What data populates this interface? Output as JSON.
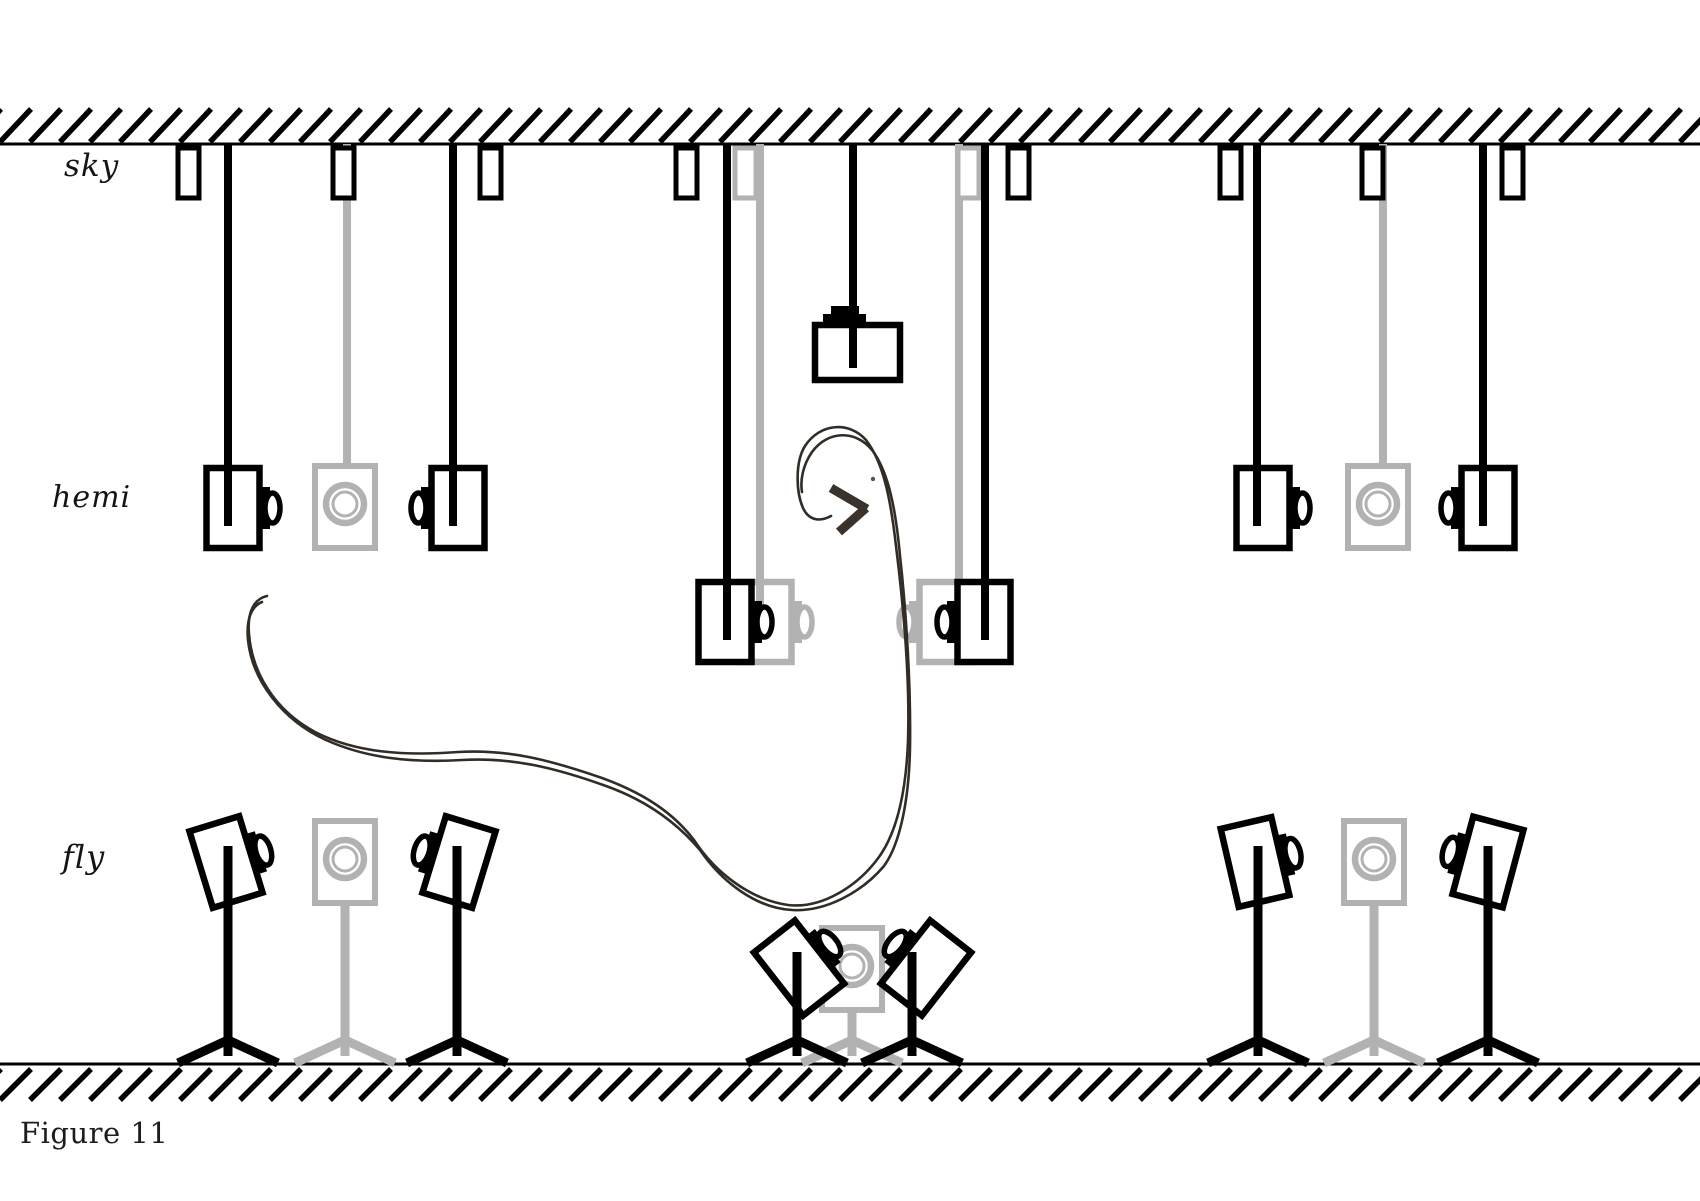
{
  "figure": {
    "caption": "Figure 11",
    "labels": [
      {
        "id": "sky",
        "text": "sky"
      },
      {
        "id": "hemi",
        "text": "hemi"
      },
      {
        "id": "fly",
        "text": "fly"
      }
    ],
    "colors": {
      "black": "#000000",
      "gray": "#b2b2b2",
      "path": "#312c26",
      "bat": "#39332c",
      "background": "#ffffff"
    },
    "canvas": {
      "w": 1700,
      "h": 1201
    },
    "ceiling": {
      "line_y": 144,
      "hatch": {
        "yb": 142,
        "yt": 109,
        "dx": 31,
        "spacing": 30,
        "stroke": 5.5
      }
    },
    "floor": {
      "line_y": 1064,
      "hatch": {
        "yb": 1100,
        "yt": 1069,
        "dx": 31,
        "spacing": 30,
        "stroke": 5.5
      }
    },
    "mounts": {
      "y": 148,
      "w": 21,
      "h": 50,
      "stroke": 5,
      "items": [
        {
          "x": 178,
          "c": "black"
        },
        {
          "x": 333,
          "c": "black"
        },
        {
          "x": 480,
          "c": "black"
        },
        {
          "x": 676,
          "c": "black"
        },
        {
          "x": 735,
          "c": "gray"
        },
        {
          "x": 958,
          "c": "gray"
        },
        {
          "x": 1008,
          "c": "black"
        },
        {
          "x": 1220,
          "c": "black"
        },
        {
          "x": 1362,
          "c": "black"
        },
        {
          "x": 1502,
          "c": "black"
        }
      ]
    },
    "rods": {
      "y1": 144,
      "stroke": 8,
      "black": [
        {
          "x": 228,
          "y2": 526
        },
        {
          "x": 453,
          "y2": 526
        },
        {
          "x": 727,
          "y2": 640
        },
        {
          "x": 853,
          "y2": 368
        },
        {
          "x": 985,
          "y2": 640
        },
        {
          "x": 1257,
          "y2": 526
        },
        {
          "x": 1483,
          "y2": 526
        }
      ],
      "gray": [
        {
          "x": 347,
          "y2": 469
        },
        {
          "x": 760,
          "y2": 640
        },
        {
          "x": 959,
          "y2": 640
        },
        {
          "x": 1383,
          "y2": 469
        }
      ]
    },
    "hanging_cameras": {
      "w": 53,
      "h": 80,
      "black": [
        {
          "cx": 233,
          "cy": 508,
          "face": 1
        },
        {
          "cx": 458,
          "cy": 508,
          "face": -1
        },
        {
          "cx": 725,
          "cy": 622,
          "face": 1
        },
        {
          "cx": 984,
          "cy": 622,
          "face": -1
        },
        {
          "cx": 1263,
          "cy": 508,
          "face": 1
        },
        {
          "cx": 1488,
          "cy": 508,
          "face": -1
        }
      ],
      "gray": [
        {
          "cx": 765,
          "cy": 622,
          "face": 1
        },
        {
          "cx": 946,
          "cy": 622,
          "face": -1
        }
      ]
    },
    "hanging_speakers": [
      {
        "cx": 345,
        "top": 466
      },
      {
        "cx": 1378,
        "top": 466
      }
    ],
    "ceiling_camera": {
      "x": 815,
      "y": 325,
      "w": 85,
      "h": 55,
      "rod_x": 853,
      "cap1": [
        823,
        314,
        43,
        12
      ],
      "cap2": [
        831,
        306,
        28,
        9
      ]
    },
    "tripod_cameras": [
      {
        "cx": 226,
        "cy": 862,
        "rot": -17,
        "face": 1,
        "pole": 228
      },
      {
        "cx": 459,
        "cy": 862,
        "rot": 17,
        "face": -1,
        "pole": 457
      },
      {
        "cx": 799,
        "cy": 968,
        "rot": -38,
        "face": 1,
        "pole": 797
      },
      {
        "cx": 926,
        "cy": 968,
        "rot": 38,
        "face": -1,
        "pole": 912
      },
      {
        "cx": 1255,
        "cy": 862,
        "rot": -13,
        "face": 1,
        "pole": 1258
      },
      {
        "cx": 1488,
        "cy": 862,
        "rot": 15,
        "face": -1,
        "pole": 1488
      }
    ],
    "tripod_speakers": [
      {
        "cx": 345,
        "top": 821
      },
      {
        "cx": 852,
        "top": 928
      },
      {
        "cx": 1374,
        "top": 821
      }
    ],
    "tripods": {
      "junction_y": 1040,
      "foot_dx": 50,
      "foot_y": 1063,
      "stub_y": 1056,
      "stroke": 9,
      "black": [
        {
          "x": 228,
          "top": 846
        },
        {
          "x": 457,
          "top": 846
        },
        {
          "x": 797,
          "top": 952
        },
        {
          "x": 912,
          "top": 952
        },
        {
          "x": 1258,
          "top": 846
        },
        {
          "x": 1488,
          "top": 846
        }
      ],
      "gray": [
        {
          "x": 345,
          "top": 901
        },
        {
          "x": 852,
          "top": 1008
        },
        {
          "x": 1374,
          "top": 901
        }
      ]
    },
    "flight_path": {
      "stroke": 2.6,
      "strokes": [
        "M 267 596 C 254 599 247 612 249 634 C 252 672 274 710 315 732 C 356 753 405 756 458 752 C 508 749 550 760 602 778 C 646 794 674 814 694 840 C 716 874 752 900 788 905 C 822 909 858 886 879 857 C 897 832 906 793 908 741 C 910 678 903 602 896 546 C 891 502 884 463 866 440 C 849 421 820 423 805 446 C 795 462 796 492 803 508 C 808 519 818 523 831 516",
        "M 262 602 C 252 606 246 618 248 640 C 252 680 282 720 326 740 C 366 758 410 763 462 760 C 512 757 556 768 606 786 C 648 801 678 824 700 850 C 722 882 756 908 792 910 C 826 912 862 892 884 866 C 900 844 909 800 910 748 C 911 684 906 610 900 556 C 896 512 889 472 872 450 C 856 430 828 430 812 452 C 803 465 800 480 802 492"
      ],
      "dot": {
        "x": 873,
        "y": 479,
        "r": 2.2
      }
    },
    "bat": {
      "stroke": 9,
      "seg1": [
        831,
        488,
        867,
        509
      ],
      "seg2": [
        866,
        508,
        839,
        532
      ]
    }
  }
}
